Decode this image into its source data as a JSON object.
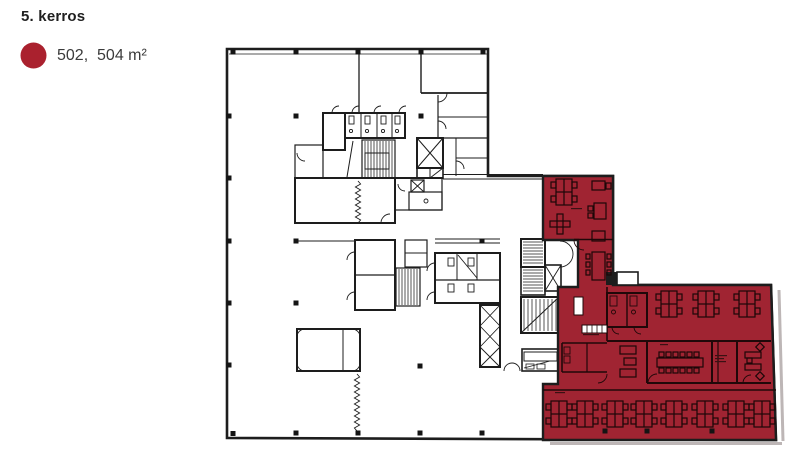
{
  "header": {
    "title": "5. kerros"
  },
  "legend": {
    "swatch_color": "#aa212e",
    "label": "502,  504 m²"
  },
  "plan": {
    "unit_id": "502",
    "area_m2": "504",
    "highlight_color": "#a02432",
    "wall_color": "#1d1d1d",
    "floor_background": "#ffffff"
  }
}
